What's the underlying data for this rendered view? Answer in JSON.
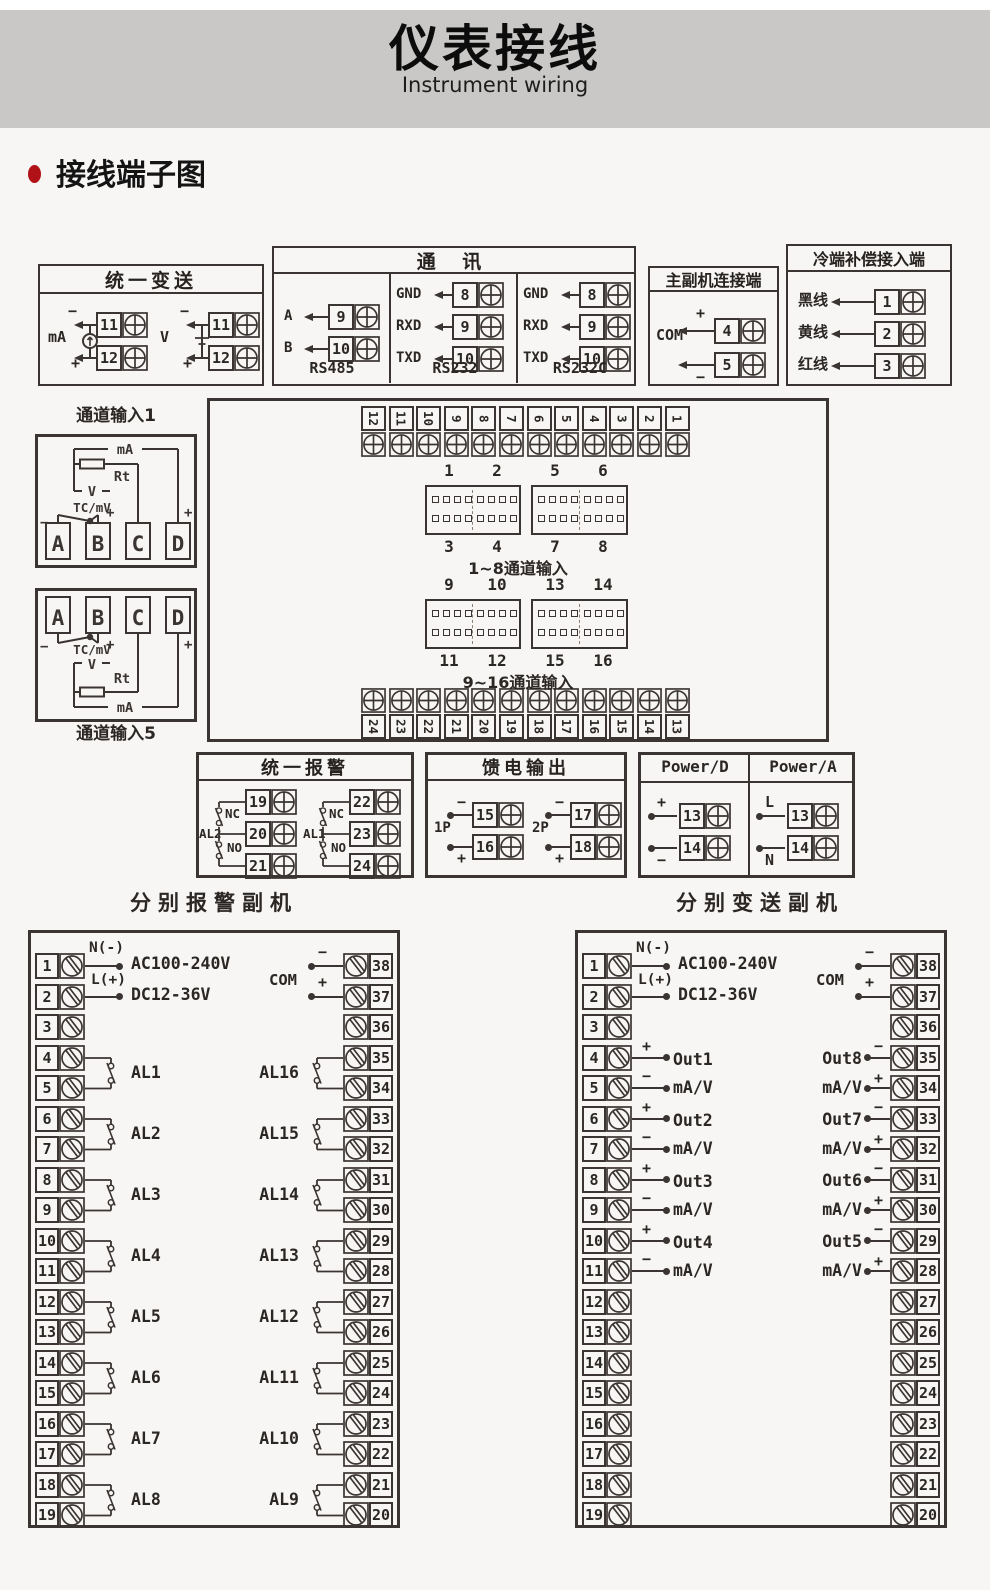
{
  "page": {
    "title": "仪表接线",
    "subtitle": "Instrument wiring",
    "section_title": "接线端子图"
  },
  "unified_transmit": {
    "title": "统一变送",
    "groups": [
      {
        "label": "mA",
        "sign_top": "−",
        "sign_bottom": "+",
        "terminals": [
          "11",
          "12"
        ],
        "symbol": "current-source"
      },
      {
        "label": "V",
        "sign_top": "−",
        "sign_bottom": "+",
        "terminals": [
          "11",
          "12"
        ],
        "symbol": "voltage"
      }
    ]
  },
  "comm": {
    "title": "通 讯",
    "columns": [
      {
        "name": "RS485",
        "rows": [
          {
            "label": "A",
            "term": "9"
          },
          {
            "label": "B",
            "term": "10"
          }
        ]
      },
      {
        "name": "RS232",
        "rows": [
          {
            "label": "GND",
            "term": "8"
          },
          {
            "label": "RXD",
            "term": "9"
          },
          {
            "label": "TXD",
            "term": "10"
          }
        ]
      },
      {
        "name": "RS232C",
        "rows": [
          {
            "label": "GND",
            "term": "8"
          },
          {
            "label": "RXD",
            "term": "9"
          },
          {
            "label": "TXD",
            "term": "10"
          }
        ]
      }
    ]
  },
  "master_slave": {
    "title": "主副机连接端",
    "com_label": "COM",
    "rows": [
      {
        "sign": "+",
        "term": "4"
      },
      {
        "sign": "−",
        "term": "5"
      }
    ]
  },
  "cold_comp": {
    "title": "冷端补偿接入端",
    "rows": [
      {
        "label": "黑线",
        "term": "1"
      },
      {
        "label": "黄线",
        "term": "2"
      },
      {
        "label": "红线",
        "term": "3"
      }
    ]
  },
  "channel1": {
    "title": "通道输入1",
    "ma": "mA",
    "rt": "Rt",
    "v": "V",
    "tc": "TC/mV",
    "minus": "−",
    "plus": "+",
    "terminals": [
      "A",
      "B",
      "C",
      "D"
    ]
  },
  "channel5": {
    "title": "通道输入5",
    "ma": "mA",
    "rt": "Rt",
    "v": "V",
    "tc": "TC/mV",
    "minus": "−",
    "plus": "+",
    "terminals": [
      "A",
      "B",
      "C",
      "D"
    ]
  },
  "main_board": {
    "top_terminals": [
      "12",
      "11",
      "10",
      "9",
      "8",
      "7",
      "6",
      "5",
      "4",
      "3",
      "2",
      "1"
    ],
    "bottom_terminals": [
      "24",
      "23",
      "22",
      "21",
      "20",
      "19",
      "18",
      "17",
      "16",
      "15",
      "14",
      "13"
    ],
    "groups": [
      {
        "top_labels": [
          "1",
          "2",
          "5",
          "6"
        ],
        "bottom_labels": [
          "3",
          "4",
          "7",
          "8"
        ],
        "caption": "1~8通道输入"
      },
      {
        "top_labels": [
          "9",
          "10",
          "13",
          "14"
        ],
        "bottom_labels": [
          "11",
          "12",
          "15",
          "16"
        ],
        "caption": "9~16通道输入"
      }
    ]
  },
  "unified_alarm": {
    "title": "统一报警",
    "relays": [
      {
        "name": "AL2",
        "nc": "NC",
        "no": "NO",
        "terminals": [
          "19",
          "20",
          "21"
        ]
      },
      {
        "name": "AL1",
        "nc": "NC",
        "no": "NO",
        "terminals": [
          "22",
          "23",
          "24"
        ]
      }
    ]
  },
  "feed_output": {
    "title": "馈电输出",
    "groups": [
      {
        "name": "1P",
        "rows": [
          {
            "sign": "−",
            "term": "15"
          },
          {
            "sign": "+",
            "term": "16"
          }
        ]
      },
      {
        "name": "2P",
        "rows": [
          {
            "sign": "−",
            "term": "17"
          },
          {
            "sign": "+",
            "term": "18"
          }
        ]
      }
    ]
  },
  "power": {
    "columns": [
      {
        "title": "Power/D",
        "rows": [
          {
            "sign": "+",
            "term": "13",
            "sign_pos": "top"
          },
          {
            "sign": "−",
            "term": "14",
            "sign_pos": "bottom"
          }
        ]
      },
      {
        "title": "Power/A",
        "rows": [
          {
            "sign": "L",
            "term": "13",
            "sign_pos": "top"
          },
          {
            "sign": "N",
            "term": "14",
            "sign_pos": "bottom"
          }
        ]
      }
    ]
  },
  "alarm_slave": {
    "title": "分别报警副机",
    "left_terminals": [
      "1",
      "2",
      "3",
      "4",
      "5",
      "6",
      "7",
      "8",
      "9",
      "10",
      "11",
      "12",
      "13",
      "14",
      "15",
      "16",
      "17",
      "18",
      "19"
    ],
    "right_terminals": [
      "38",
      "37",
      "36",
      "35",
      "34",
      "33",
      "32",
      "31",
      "30",
      "29",
      "28",
      "27",
      "26",
      "25",
      "24",
      "23",
      "22",
      "21",
      "20"
    ],
    "power": {
      "neutral": "N(-)",
      "live": "L(+)",
      "volt1": "AC100-240V",
      "volt2": "DC12-36V"
    },
    "com": {
      "label": "COM",
      "top_sign": "−",
      "bottom_sign": "+"
    },
    "left_relays": [
      {
        "name": "AL1",
        "row": 4
      },
      {
        "name": "AL2",
        "row": 6
      },
      {
        "name": "AL3",
        "row": 8
      },
      {
        "name": "AL4",
        "row": 10
      },
      {
        "name": "AL5",
        "row": 12
      },
      {
        "name": "AL6",
        "row": 14
      },
      {
        "name": "AL7",
        "row": 16
      },
      {
        "name": "AL8",
        "row": 18
      }
    ],
    "right_relays": [
      {
        "name": "AL16",
        "row": 4
      },
      {
        "name": "AL15",
        "row": 6
      },
      {
        "name": "AL14",
        "row": 8
      },
      {
        "name": "AL13",
        "row": 10
      },
      {
        "name": "AL12",
        "row": 12
      },
      {
        "name": "AL11",
        "row": 14
      },
      {
        "name": "AL10",
        "row": 16
      },
      {
        "name": "AL9",
        "row": 18
      }
    ]
  },
  "transmit_slave": {
    "title": "分别变送副机",
    "left_terminals": [
      "1",
      "2",
      "3",
      "4",
      "5",
      "6",
      "7",
      "8",
      "9",
      "10",
      "11",
      "12",
      "13",
      "14",
      "15",
      "16",
      "17",
      "18",
      "19"
    ],
    "right_terminals": [
      "38",
      "37",
      "36",
      "35",
      "34",
      "33",
      "32",
      "31",
      "30",
      "29",
      "28",
      "27",
      "26",
      "25",
      "24",
      "23",
      "22",
      "21",
      "20"
    ],
    "power": {
      "neutral": "N(-)",
      "live": "L(+)",
      "volt1": "AC100-240V",
      "volt2": "DC12-36V"
    },
    "com": {
      "label": "COM",
      "top_sign": "−",
      "bottom_sign": "+"
    },
    "signs": {
      "left_top": "+",
      "left_bottom": "−",
      "right_top": "−",
      "right_bottom": "+"
    },
    "left_outputs": [
      {
        "name": "Out1",
        "unit": "mA/V",
        "row": 4
      },
      {
        "name": "Out2",
        "unit": "mA/V",
        "row": 6
      },
      {
        "name": "Out3",
        "unit": "mA/V",
        "row": 8
      },
      {
        "name": "Out4",
        "unit": "mA/V",
        "row": 10
      }
    ],
    "right_outputs": [
      {
        "name": "Out8",
        "unit": "mA/V",
        "row": 4
      },
      {
        "name": "Out7",
        "unit": "mA/V",
        "row": 6
      },
      {
        "name": "Out6",
        "unit": "mA/V",
        "row": 8
      },
      {
        "name": "Out5",
        "unit": "mA/V",
        "row": 10
      }
    ]
  }
}
